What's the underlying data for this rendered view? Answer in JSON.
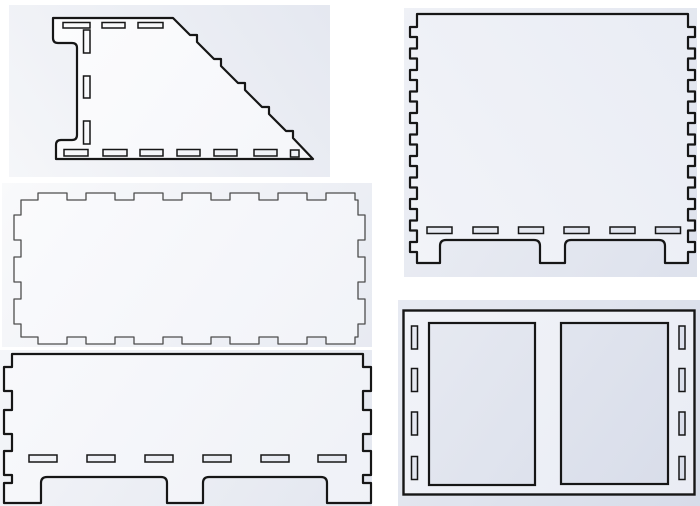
{
  "canvas": {
    "width": 700,
    "height": 506,
    "background": "#ffffff"
  },
  "colors": {
    "canvas_background": "#ffffff",
    "backdrop_gradient_start": "#fefefe",
    "backdrop_gradient_end": "#d7dce9",
    "panel_gradient_start": "#fdfdfe",
    "panel_gradient_end": "#e9ecf4",
    "slot_fill": "#f2f4f9",
    "outline_bold": "#161616",
    "outline_thin": "#4d4d4d"
  },
  "pieces": [
    {
      "id": "sloped-side-panel",
      "description": "Side panel with stepped diagonal top edge, notched left edge, 3 top slots, 3 vertical slots, 7 bottom slots",
      "top_slots": 3,
      "vertical_slots": 3,
      "bottom_slots": 7
    },
    {
      "id": "tall-footed-panel",
      "description": "Tall panel with finger tabs on both sides, 6 bottom slots and 3 feet",
      "side_tabs_per_edge": 11,
      "bottom_slots": 6,
      "feet": 3
    },
    {
      "id": "tabbed-base-plate",
      "description": "Rectangular plate with finger tabs on all four edges (7 top, 7 bottom, 3 left, 3 right)",
      "top_tabs": 7,
      "bottom_tabs": 7,
      "side_tabs_per_edge": 3
    },
    {
      "id": "wide-footed-panel",
      "description": "Wide panel with finger tabs on both sides, 6 bottom slots and 3 feet",
      "side_tabs_per_edge": 3,
      "bottom_slots": 6,
      "feet": 3
    },
    {
      "id": "double-window-divider",
      "description": "Rectangular divider with two large window cutouts and 4 vertical slots along each side",
      "windows": 2,
      "side_slots_per_edge": 4
    }
  ]
}
